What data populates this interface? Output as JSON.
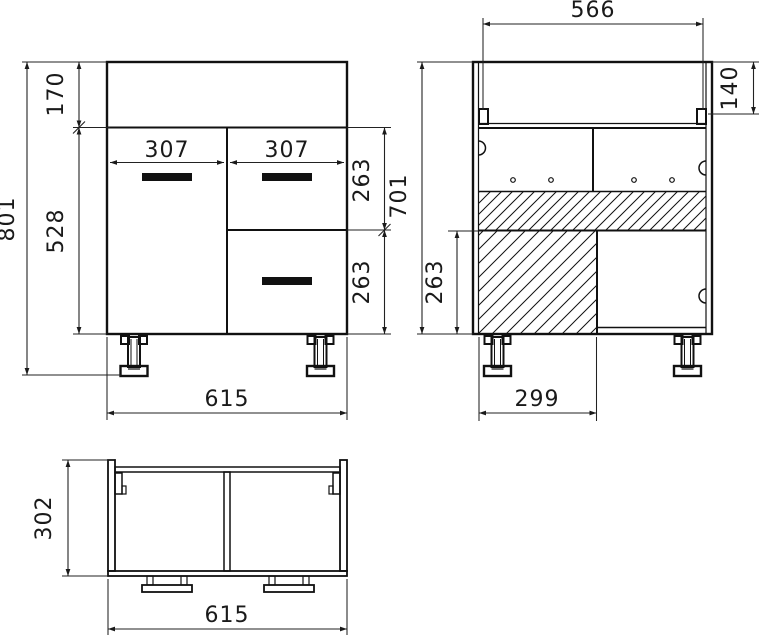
{
  "title": "Cabinet technical drawing, three orthographic views",
  "colors": {
    "line": "#111111",
    "background": "#ffffff",
    "handle": "#111111"
  },
  "front": {
    "name": "front view",
    "dims": {
      "overall_height": "801",
      "top_section_height": "170",
      "door_height": "528",
      "door_width": "307",
      "drawer_width": "307",
      "top_drawer_height": "263",
      "bottom_drawer_height": "263",
      "overall_width": "615"
    }
  },
  "section": {
    "name": "rear section view",
    "dims": {
      "inner_width": "566",
      "top_rail_height": "140",
      "carcass_height": "701",
      "recess_height": "263",
      "recess_width": "299"
    }
  },
  "top": {
    "name": "top (plan) view",
    "dims": {
      "depth": "302",
      "overall_width": "615"
    }
  }
}
